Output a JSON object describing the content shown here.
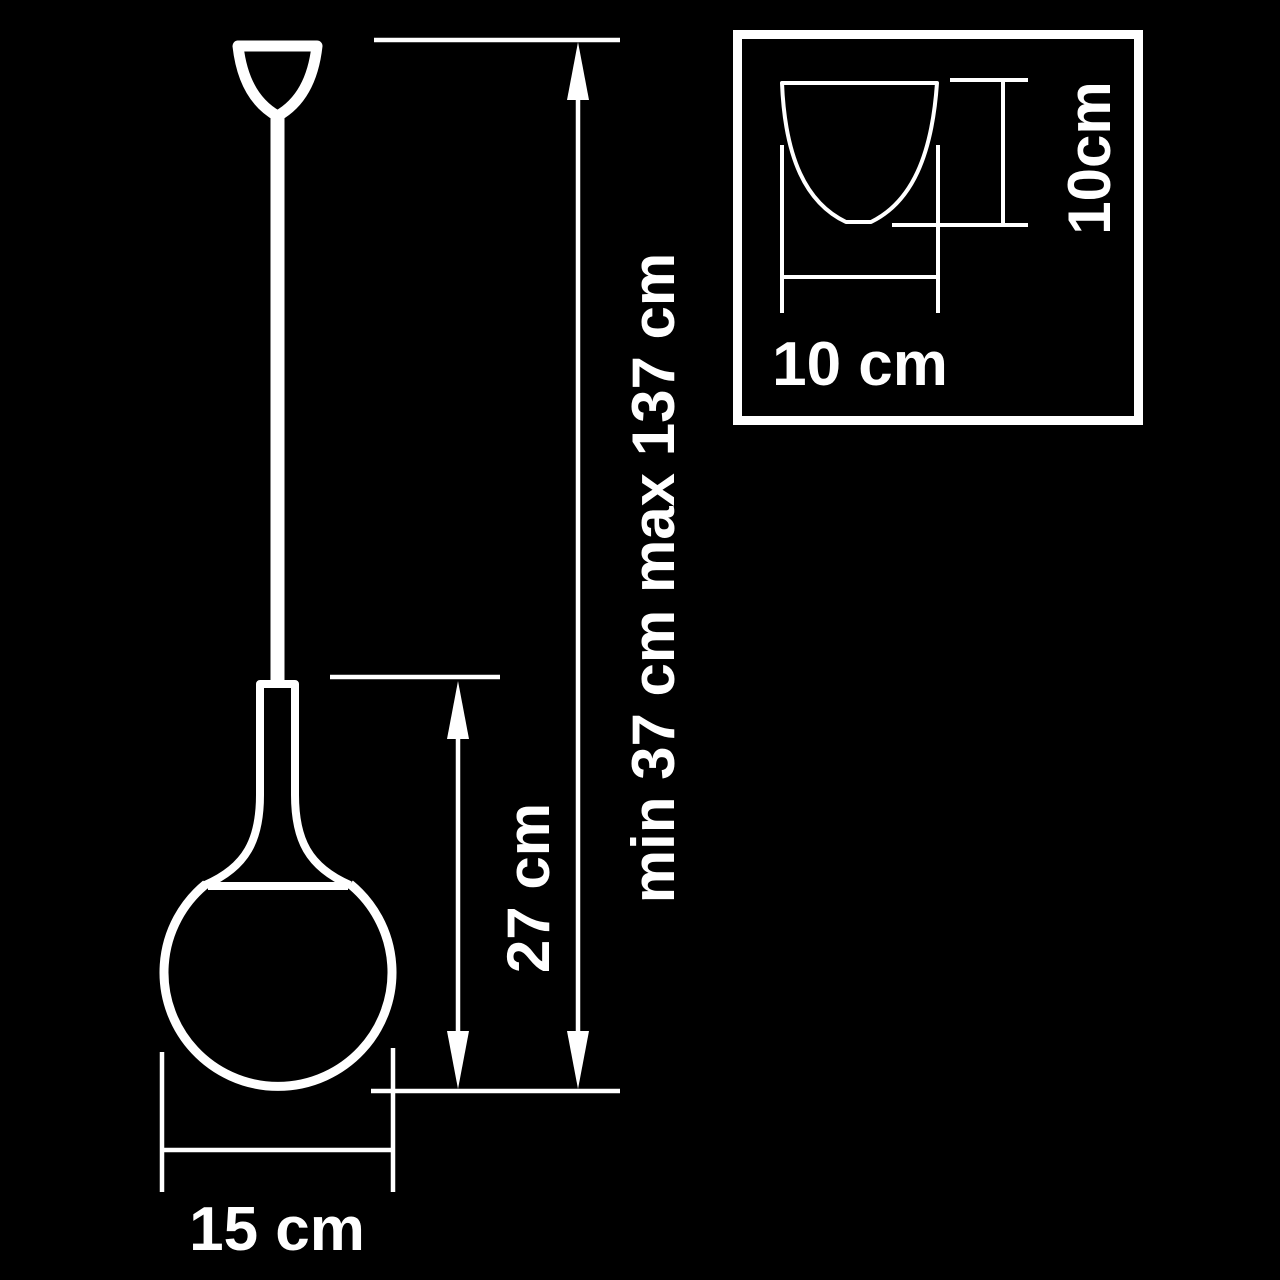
{
  "page": {
    "background_color": "#000000",
    "line_color": "#ffffff"
  },
  "diagram": {
    "kind": "pendant-lamp-dimension-drawing",
    "labels": {
      "suspension_height": "min 37 cm max 137 cm",
      "fixture_height": "27 cm",
      "shade_diameter": "15 cm",
      "canopy_width": "10 cm",
      "canopy_height": "10cm"
    },
    "values": {
      "suspension_min_cm": 37,
      "suspension_max_cm": 137,
      "fixture_height_cm": 27,
      "shade_diameter_cm": 15,
      "canopy_width_cm": 10,
      "canopy_height_cm": 10
    }
  }
}
